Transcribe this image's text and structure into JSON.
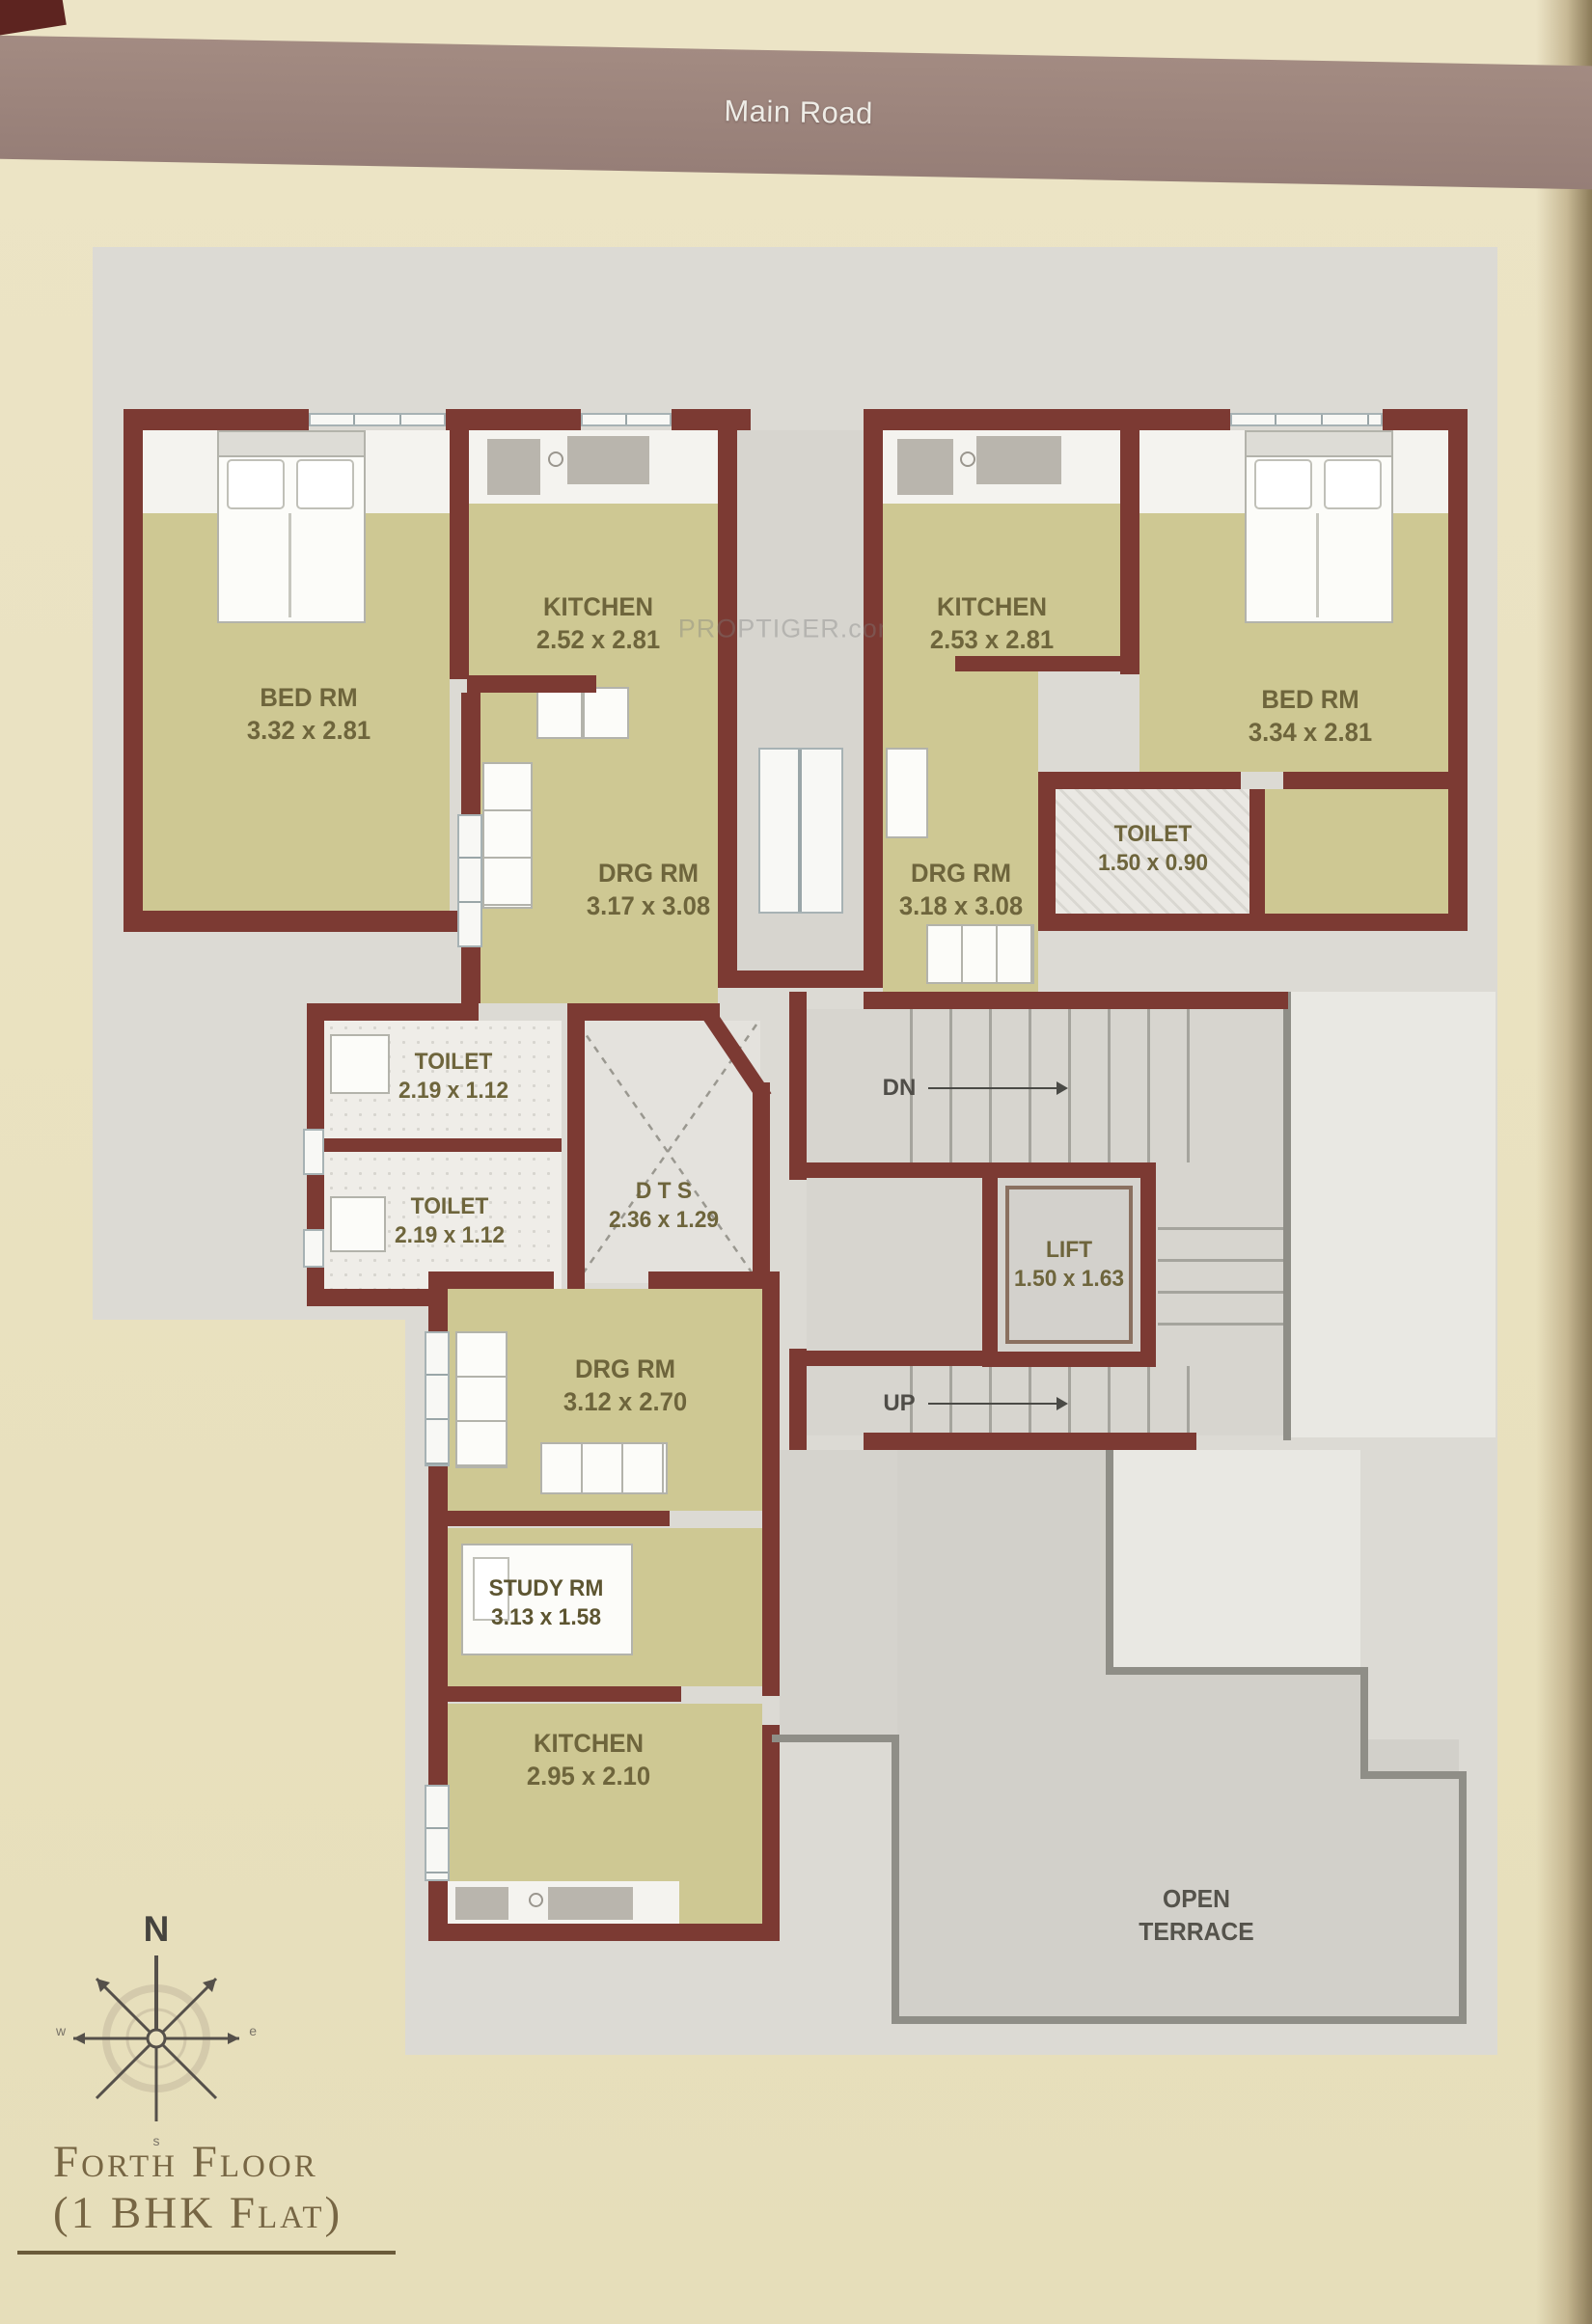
{
  "page": {
    "road_label": "Main Road",
    "watermark": "PROPTIGER.com"
  },
  "title": {
    "line1": "Forth Floor",
    "line2": "(1 BHK Flat)"
  },
  "compass": {
    "north": "N",
    "west": "w",
    "east": "e",
    "south": "s"
  },
  "stairs": {
    "down_label": "DN",
    "up_label": "UP"
  },
  "rooms": {
    "bed_left": {
      "name": "BED RM",
      "dims": "3.32 x 2.81"
    },
    "kitchen_left": {
      "name": "KITCHEN",
      "dims": "2.52 x 2.81"
    },
    "kitchen_right": {
      "name": "KITCHEN",
      "dims": "2.53 x 2.81"
    },
    "bed_right": {
      "name": "BED RM",
      "dims": "3.34 x 2.81"
    },
    "toilet_right": {
      "name": "TOILET",
      "dims": "1.50 x 0.90"
    },
    "drg_left": {
      "name": "DRG RM",
      "dims": "3.17 x 3.08"
    },
    "drg_right": {
      "name": "DRG RM",
      "dims": "3.18 x 3.08"
    },
    "toilet_upper": {
      "name": "TOILET",
      "dims": "2.19 x 1.12"
    },
    "toilet_lower": {
      "name": "TOILET",
      "dims": "2.19 x 1.12"
    },
    "dts": {
      "name": "D T S",
      "dims": "2.36 x 1.29"
    },
    "lift": {
      "name": "LIFT",
      "dims": "1.50 x 1.63"
    },
    "drg_lower": {
      "name": "DRG RM",
      "dims": "3.12 x 2.70"
    },
    "study": {
      "name": "STUDY RM",
      "dims": "3.13 x 1.58"
    },
    "kitchen_lower": {
      "name": "KITCHEN",
      "dims": "2.95 x 2.10"
    },
    "terrace": {
      "line1": "OPEN",
      "line2": "TERRACE"
    }
  },
  "colors": {
    "wall": "#7c3a33",
    "room_fill": "#cec893",
    "floor_gray": "#dcdad4",
    "terrace_gray": "#d2d0ca",
    "terrace_border": "#8f8e87",
    "road_band": "#9c857d",
    "page_beige": "#e9e1bf",
    "label_text": "#6e653c",
    "title_text": "#776644"
  }
}
